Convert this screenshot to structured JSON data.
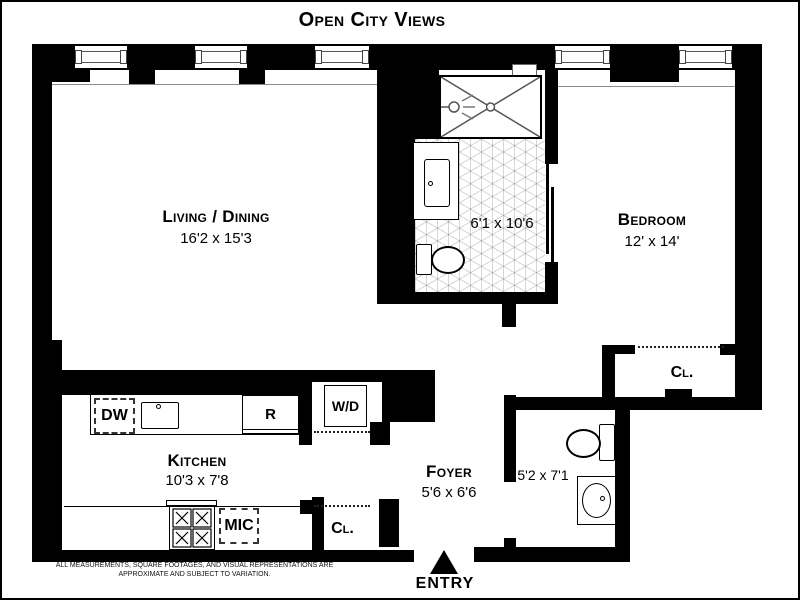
{
  "title": "Open City Views",
  "rooms": {
    "living": {
      "name": "Living / Dining",
      "dims": "16'2 x 15'3"
    },
    "bedroom": {
      "name": "Bedroom",
      "dims": "12' x 14'"
    },
    "kitchen": {
      "name": "Kitchen",
      "dims": "10'3 x 7'8"
    },
    "foyer": {
      "name": "Foyer",
      "dims": "5'6 x 6'6"
    },
    "bath_main": {
      "dims": "6'1 x 10'6"
    },
    "bath_second": {
      "dims": "5'2 x 7'1"
    }
  },
  "fixtures": {
    "dishwasher": "DW",
    "refrigerator": "R",
    "microwave": "MIC",
    "washer_dryer": "W/D",
    "closet_kitchen": "Cl.",
    "closet_bedroom": "Cl."
  },
  "entry_label": "ENTRY",
  "disclaimer": {
    "line1": "ALL MEASUREMENTS, SQUARE FOOTAGES, AND VISUAL REPRESENTATIONS ARE",
    "line2": "APPROXIMATE AND SUBJECT TO VARIATION."
  },
  "colors": {
    "wall": "#000000",
    "tile_line": "#c9c9c9",
    "sill_line": "#8a8a8a"
  }
}
